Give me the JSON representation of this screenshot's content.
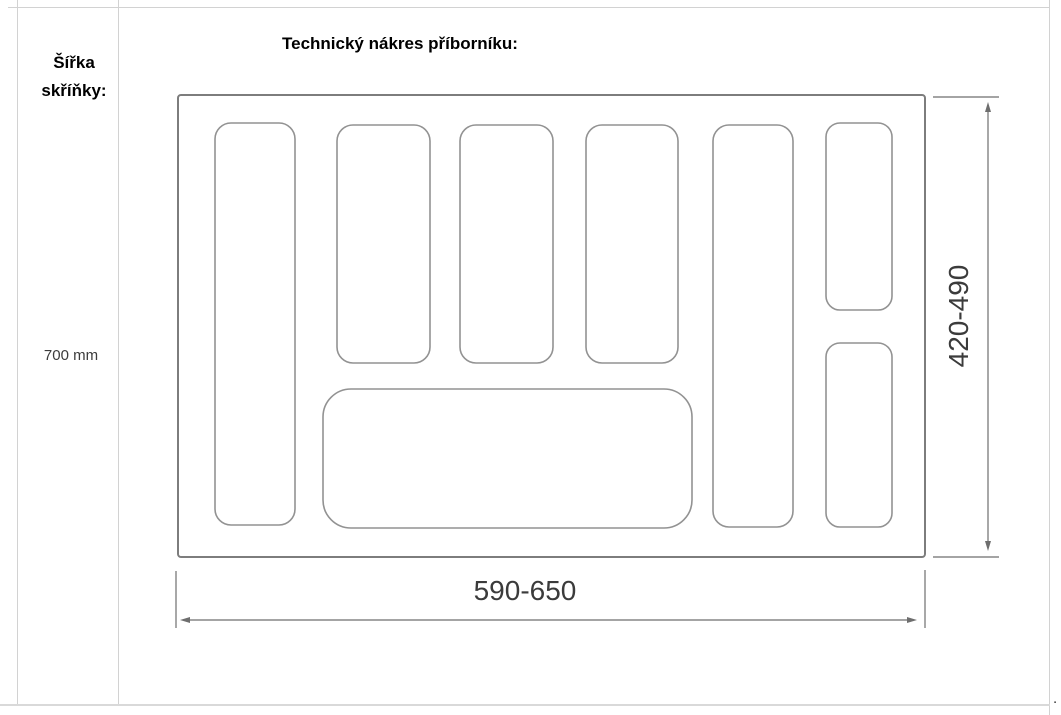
{
  "left_cell": {
    "label_line1": "Šířka",
    "label_line2": "skříňky:",
    "value": "700 mm"
  },
  "main": {
    "title": "Technický nákres příborníku:",
    "trailing_dot": "."
  },
  "drawing": {
    "bottom_dimension_label": "590-650",
    "side_dimension_label": "420-490"
  },
  "colors": {
    "tray_outline": "#7d7d7d",
    "compartment_stroke": "#929292",
    "dimension_line": "#6e6e6e",
    "dimension_text": "#3b3b3b"
  }
}
